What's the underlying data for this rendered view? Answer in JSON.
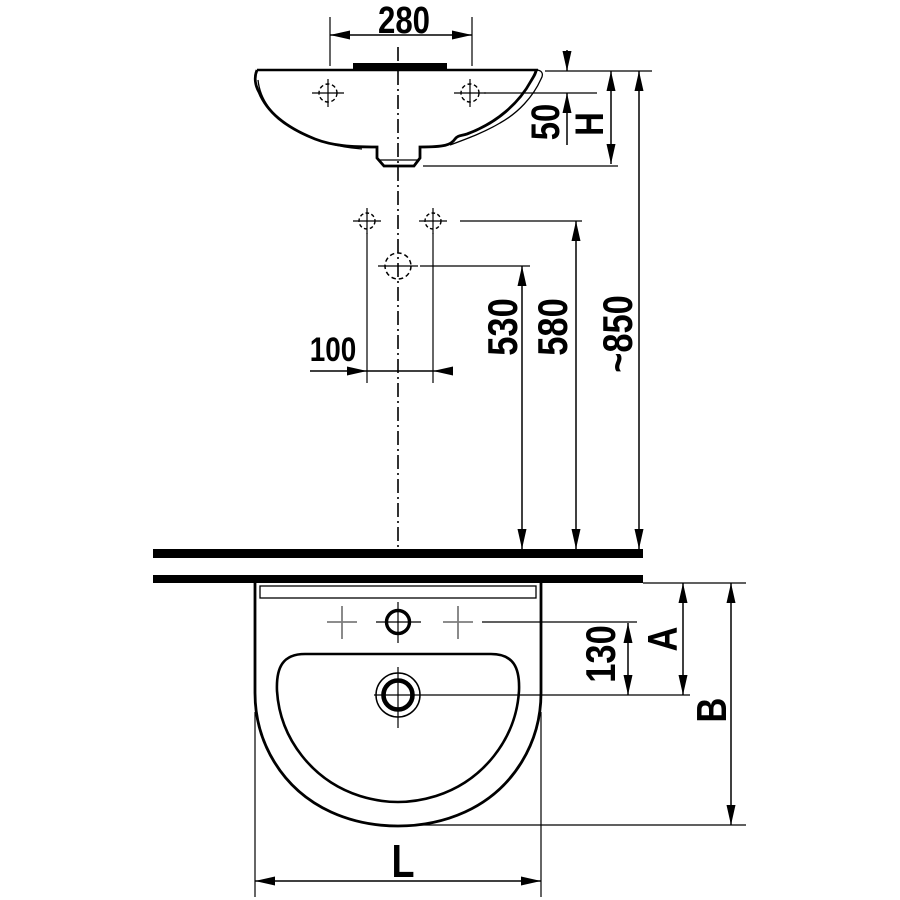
{
  "drawing": {
    "kind": "wall-hung washbasin installation dimension drawing",
    "views": [
      "side profile view",
      "front view"
    ],
    "colors": {
      "line": "#000000",
      "secondary_marker": "#7d7d7d",
      "background": "#ffffff"
    }
  },
  "dimensions": {
    "side_view": {
      "tap_holes_spacing": "280",
      "rim_to_tap_holes": "50",
      "basin_height": "H",
      "fixing_holes_spacing": "100",
      "drain_outlet_height": "530",
      "fixing_holes_height": "580",
      "rim_height_above_floor": "~850"
    },
    "front_view": {
      "tap_hole_to_drain": "130",
      "depth_a": "A",
      "depth_b": "B",
      "overall_length": "L"
    }
  }
}
